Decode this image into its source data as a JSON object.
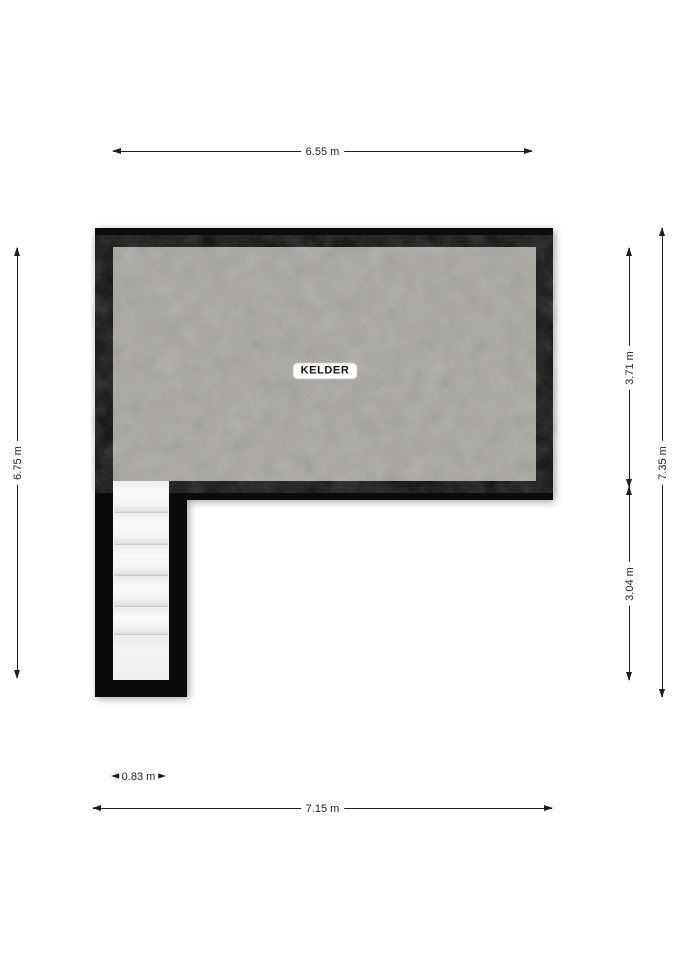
{
  "plan": {
    "room_label": "KELDER",
    "stairs_steps": 6,
    "dimensions": {
      "top_width": "6.55 m",
      "left_height": "6.75 m",
      "right_upper": "3.71 m",
      "right_lower": "3.04 m",
      "right_total": "7.35 m",
      "stairwell_width": "0.83 m",
      "bottom_width": "7.15 m"
    },
    "colors": {
      "background": "#ffffff",
      "wall": "#0b0b0b",
      "floor": "#a8a5a0",
      "stair_tread": "#f2f2f2",
      "dimension": "#1f1f1f"
    }
  }
}
